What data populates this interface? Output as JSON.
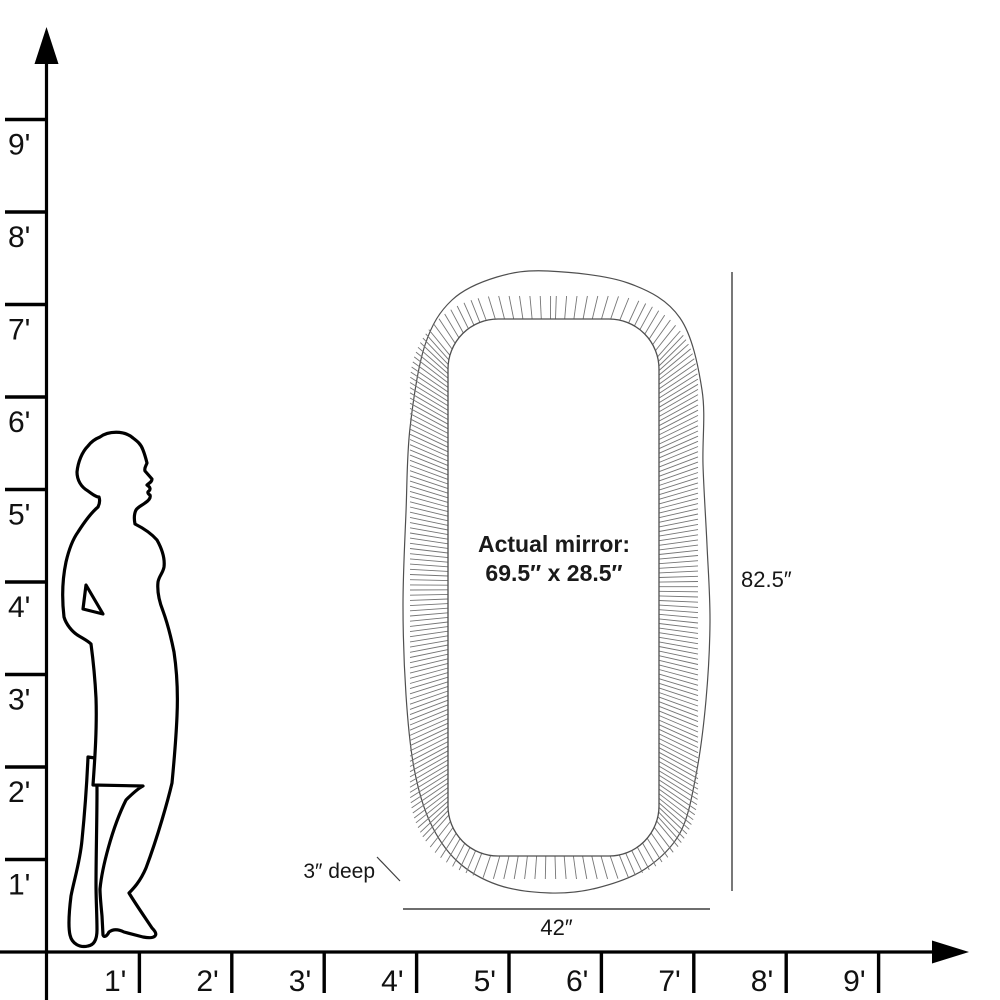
{
  "diagram_type": "mirror scale drawing",
  "mirror": {
    "label_line1": "Actual mirror:",
    "label_line2": "69.5″ x 28.5″",
    "height_label": "82.5″",
    "width_label": "42″",
    "depth_label": "3″ deep"
  },
  "axes": {
    "unit": "feet",
    "vertical_labels": [
      "1'",
      "2'",
      "3'",
      "4'",
      "5'",
      "6'",
      "7'",
      "8'",
      "9'"
    ],
    "horizontal_labels": [
      "1'",
      "2'",
      "3'",
      "4'",
      "5'",
      "6'",
      "7'",
      "8'",
      "9'"
    ]
  },
  "colors": {
    "ink": "#000000",
    "drawing": "#4f4f4f",
    "flute": "#757575",
    "dimension": "#3f3f3f",
    "text": "#161616"
  }
}
